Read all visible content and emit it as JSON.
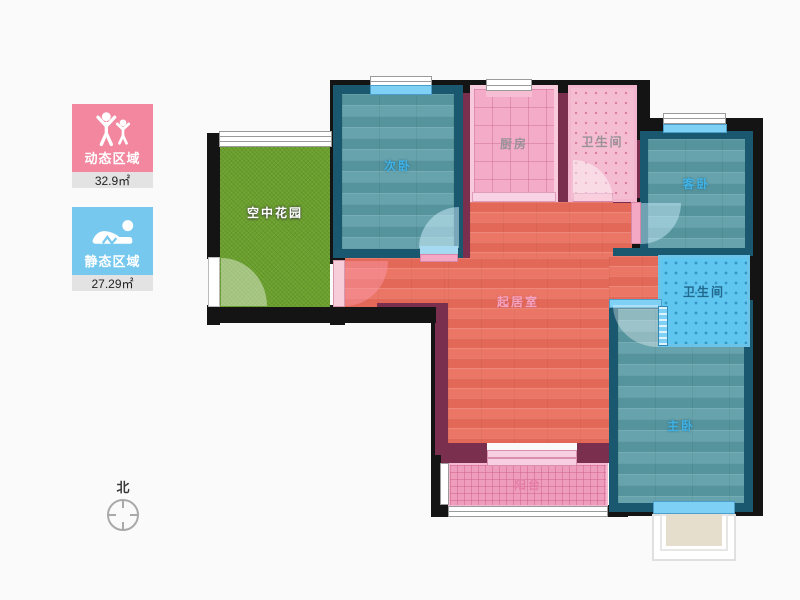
{
  "legend": {
    "items": [
      {
        "id": "dynamic",
        "label": "动态区域",
        "area": "32.9㎡",
        "color": "#f2879f",
        "icon": "people-active-icon"
      },
      {
        "id": "static",
        "label": "静态区域",
        "area": "27.29㎡",
        "color": "#76c8ef",
        "icon": "person-resting-icon"
      }
    ]
  },
  "compass": {
    "label": "北"
  },
  "floorplan": {
    "rooms": {
      "sky_garden": {
        "label": "空中花园",
        "floor_color": "#6aa02c"
      },
      "secondary_bedroom": {
        "label": "次卧",
        "floor_color": "#5e9da7"
      },
      "kitchen": {
        "label": "厨房",
        "floor_color": "#f3abc7"
      },
      "bathroom_top": {
        "label": "卫生间",
        "floor_color": "#f5bdd2"
      },
      "guest_bedroom": {
        "label": "客卧",
        "floor_color": "#5e9da7"
      },
      "living_room": {
        "label": "起居室",
        "floor_color": "#ea6f5e"
      },
      "bathroom_right": {
        "label": "卫生间",
        "floor_color": "#5fc6ef"
      },
      "master_bedroom": {
        "label": "主卧",
        "floor_color": "#5e9da7"
      },
      "balcony": {
        "label": "阳台",
        "floor_color": "#ef9dbc"
      }
    },
    "palette": {
      "outer_wall": "#141414",
      "interior_wall": "#7b2f4f",
      "bedroom_border": "#19586f",
      "window_blue": "#7ed0f4"
    }
  }
}
